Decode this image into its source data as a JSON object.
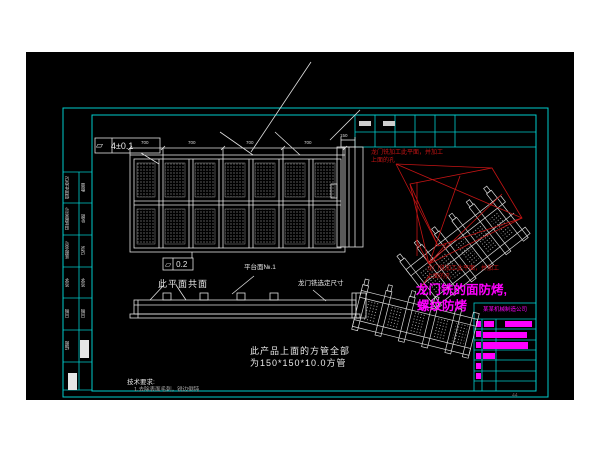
{
  "window": {
    "background": "#ffffff",
    "canvas_background": "#000000"
  },
  "colors": {
    "frame": "#00cdcd",
    "line": "#e8e8e8",
    "annotation_red": "#c41414",
    "highlight_magenta": "#ff00ff"
  },
  "tolerance_frames": {
    "top": {
      "symbol": "⏥",
      "value": "4±0.1"
    },
    "mid": {
      "symbol": "⏥",
      "value": "0.2"
    }
  },
  "notes": {
    "coplanar": "此平面共面",
    "platform_plate": "平台面№.1",
    "gantry_mill_size": "龙门铣选定尺寸",
    "square_tube_1": "此产品上面的方管全部",
    "square_tube_2": "为150*150*10.0方管",
    "tech_req_title": "技术要求:",
    "tech_req_item_1": "1.去除表面毛刺，锐边倒钝"
  },
  "red_annotations": {
    "upper_1": "龙门铣加工此平面，并加工",
    "upper_2": "上面的孔",
    "lower_1": "龙门铣加工此平面，并加工",
    "lower_2": "上面的孔"
  },
  "magenta_annotation": {
    "line_1": "龙门铣的面防烤,",
    "line_2": "螺纹防烤"
  },
  "dimensions": {
    "plan_top": [
      "700",
      "700",
      "700",
      "700"
    ],
    "side_view": "150"
  },
  "title_block": {
    "company": "某某机械制造公司"
  },
  "revision_strip": {
    "rows": [
      {
        "label": "借用件登记",
        "note": "数量"
      },
      {
        "label": "旧底图总号",
        "note": "处数"
      },
      {
        "label": "底图总号",
        "note": "记录"
      },
      {
        "label": "签字",
        "note": "签字"
      },
      {
        "label": "日期",
        "note": "日期"
      },
      {
        "label": "描图",
        "note": ""
      }
    ]
  },
  "footer_mark": "44"
}
